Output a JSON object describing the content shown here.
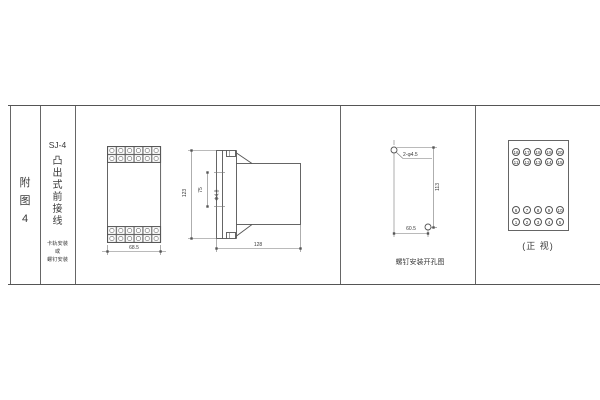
{
  "palette": {
    "background": "#ffffff",
    "line": "#555555",
    "text": "#3a3a3a"
  },
  "index_column": {
    "chars": [
      "附",
      "图",
      "4"
    ]
  },
  "title_column": {
    "model": "SJ-4",
    "title_chars": [
      "凸",
      "出",
      "式",
      "前",
      "接",
      "线"
    ],
    "note_lines": [
      "卡轨安装",
      "或",
      "螺钉安装"
    ]
  },
  "front_view": {
    "width_dim": "68.5"
  },
  "side_view": {
    "height_dim": "123",
    "hole_span_dim": "75",
    "hole_dia_label": "Φ4.8",
    "depth_dim": "128"
  },
  "drill_view": {
    "hole_label": "2-φ4.5",
    "vertical_dim": "113",
    "horizontal_dim": "60.5",
    "caption": "螺钉安装开孔图"
  },
  "terminal_view": {
    "rows": [
      [
        "16",
        "17",
        "18",
        "19",
        "20"
      ],
      [
        "11",
        "12",
        "13",
        "14",
        "15"
      ],
      [
        "6",
        "7",
        "8",
        "9",
        "10"
      ],
      [
        "1",
        "2",
        "3",
        "4",
        "5"
      ]
    ],
    "caption": "(正 视)"
  }
}
